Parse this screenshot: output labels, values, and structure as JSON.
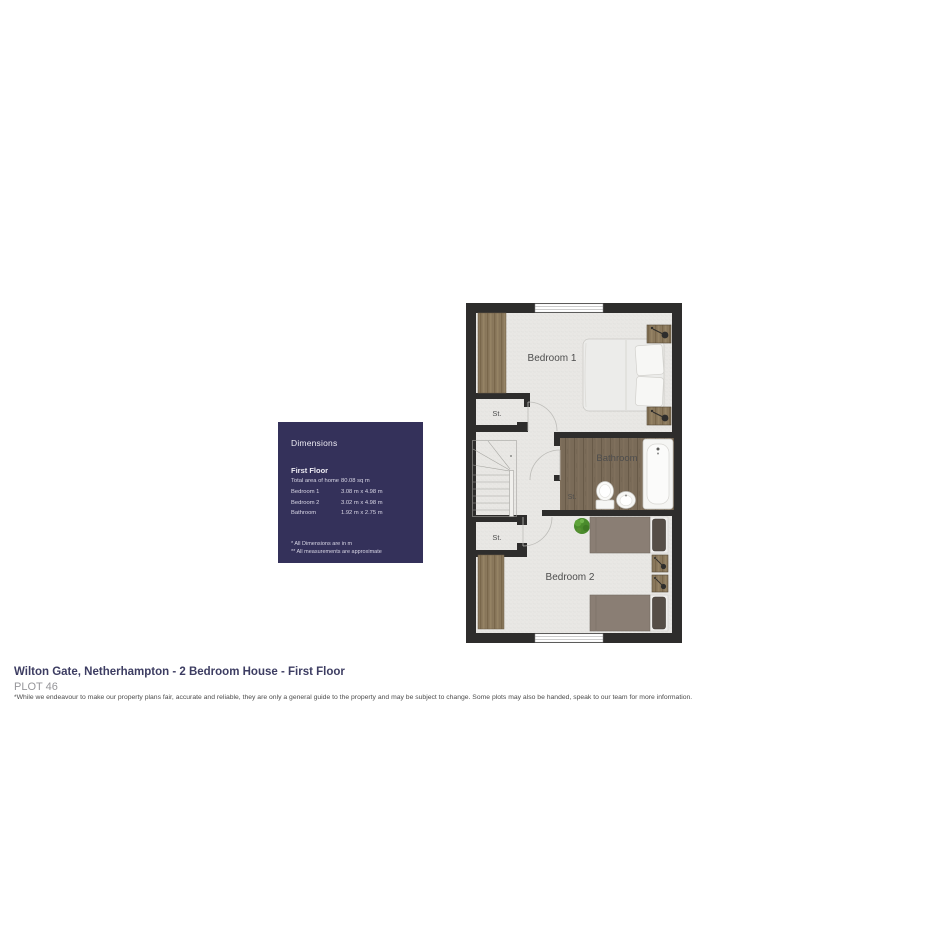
{
  "floorplan": {
    "labels": {
      "bedroom1": "Bedroom 1",
      "bedroom2": "Bedroom 2",
      "bathroom": "Bathroom",
      "storage": "St."
    }
  },
  "dimensions_panel": {
    "title": "Dimensions",
    "section": "First Floor",
    "rows": [
      {
        "label": "Total area of home",
        "value": "80.08 sq m"
      },
      {
        "label": "Bedroom 1",
        "value": "3.08 m x 4.98 m"
      },
      {
        "label": "Bedroom 2",
        "value": "3.02 m x 4.98 m"
      },
      {
        "label": "Bathroom",
        "value": "1.92 m x 2.75 m"
      }
    ],
    "footnotes": [
      "* All Dimensions are in m",
      "** All measurements are approximate"
    ]
  },
  "footer": {
    "title": "Wilton Gate, Netherhampton - 2 Bedroom House - First Floor",
    "plot": "PLOT 46",
    "disclaimer": "*While we endeavour to make our property plans fair, accurate and reliable, they are only a general guide to the property and may be subject to change. Some plots may also be handed, speak to our team for more information."
  },
  "colors": {
    "panel_bg": "#34315a",
    "wall": "#2e2d2c",
    "title_text": "#3d3d62",
    "wood_floor": "#7a6b58",
    "wardrobe_wood": "#8c7a5e",
    "bed2_duvet": "#8a7e74",
    "plant_green": "#4a8b2c"
  }
}
